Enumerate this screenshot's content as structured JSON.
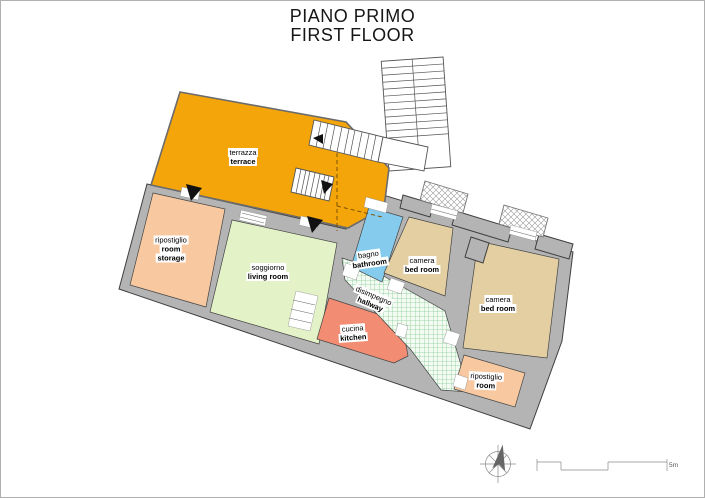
{
  "title": {
    "line1": "PIANO PRIMO",
    "line2": "FIRST FLOOR"
  },
  "rooms": [
    {
      "id": "terrace",
      "lines": [
        "terrazza",
        "terrace"
      ]
    },
    {
      "id": "storage-1",
      "lines": [
        "ripostiglio",
        "room",
        "storage"
      ]
    },
    {
      "id": "living-room",
      "lines": [
        "soggiorno",
        "living room"
      ]
    },
    {
      "id": "bathroom",
      "lines": [
        "bagno",
        "bathroom"
      ]
    },
    {
      "id": "bedroom-1",
      "lines": [
        "camera",
        "bed room"
      ]
    },
    {
      "id": "bedroom-2",
      "lines": [
        "camera",
        "bed room"
      ]
    },
    {
      "id": "hallway",
      "lines": [
        "disimpegno",
        "hallway"
      ]
    },
    {
      "id": "kitchen",
      "lines": [
        "cucina",
        "kitchen"
      ]
    },
    {
      "id": "storage-2",
      "lines": [
        "ripostiglio",
        "room",
        "storage"
      ]
    }
  ],
  "scale": {
    "label": "5m"
  },
  "colors": {
    "terrace": "#f3a50a",
    "storage": "#f8c9a0",
    "living_room": "#e4f3c7",
    "bathroom": "#85cbee",
    "bedroom": "#e3cfa2",
    "kitchen": "#f28c72",
    "hallway_grid": "#86cf96",
    "wall": "#b4b4b4"
  }
}
